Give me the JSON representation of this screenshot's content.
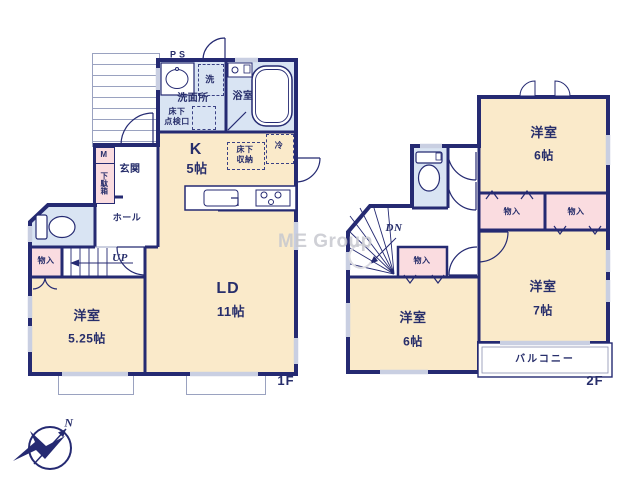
{
  "meta": {
    "floor1_label": "1F",
    "floor2_label": "2F",
    "watermark": "ME Group",
    "north": "N"
  },
  "colors": {
    "wall": "#252a72",
    "room_cream": "#faeaca",
    "wet_blue": "#d9e4f3",
    "closet_pink": "#fadce0",
    "window_gray": "#c9cfe2"
  },
  "floor1": {
    "kitchen": {
      "name": "K",
      "size": "5帖"
    },
    "living": {
      "name": "LD",
      "size": "11帖"
    },
    "bedroom": {
      "name": "洋室",
      "size": "5.25帖"
    },
    "entrance": "玄関",
    "hall": "ホール",
    "washroom": "洗面所",
    "bathroom": "浴室",
    "laundry": "洗",
    "fridge": "冷",
    "underfloor_storage": "床下\n収納",
    "underfloor_hatch": "床下\n点検口",
    "storage": "物入",
    "shoe_box": "下駄箱",
    "meter": "M",
    "pipe_space": "PS",
    "stairs_up": "UP"
  },
  "floor2": {
    "bedroom_north": {
      "name": "洋室",
      "size": "6帖"
    },
    "bedroom_south": {
      "name": "洋室",
      "size": "6帖"
    },
    "bedroom_east": {
      "name": "洋室",
      "size": "7帖"
    },
    "closet_a": "物入",
    "closet_b": "物入",
    "closet_c": "物入",
    "balcony": "バルコニー",
    "stairs_down": "DN"
  }
}
